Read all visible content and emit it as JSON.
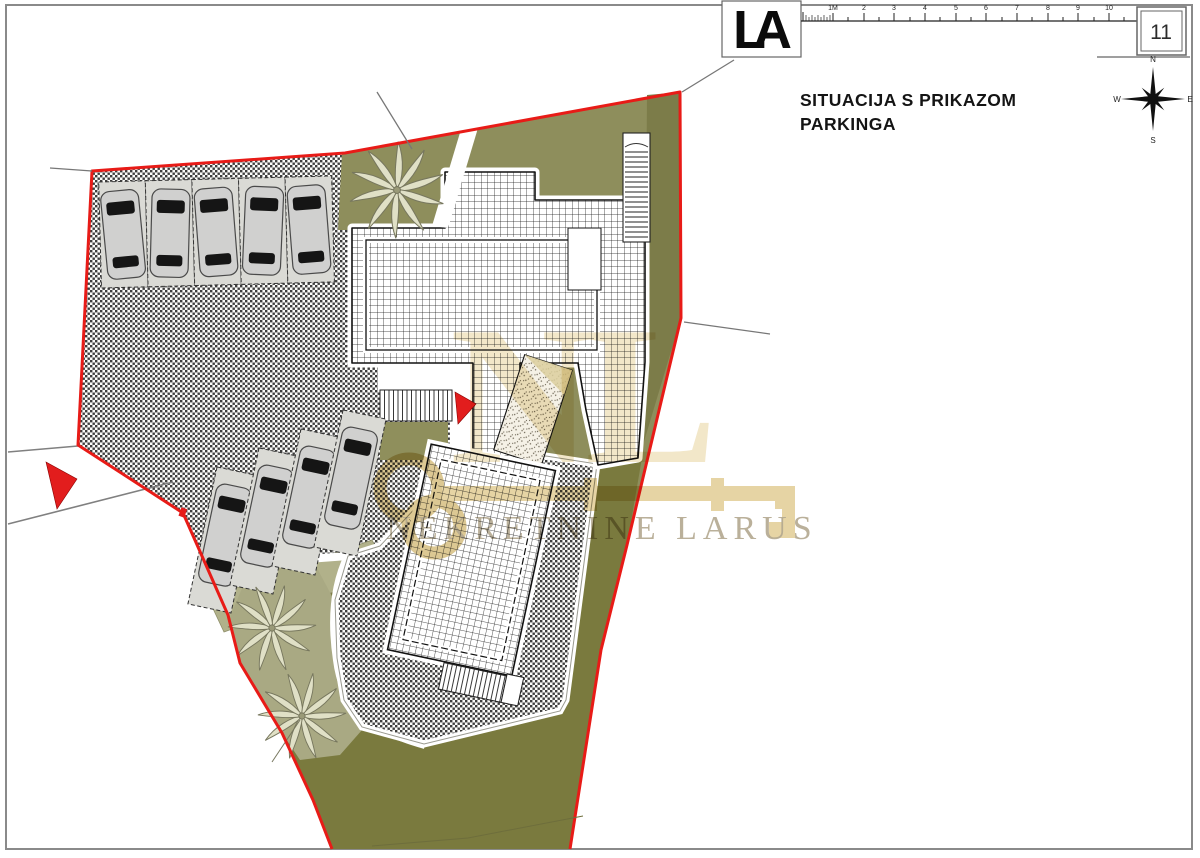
{
  "header": {
    "logo": "LA",
    "sheet_number": "11",
    "title_line1": "SITUACIJA S PRIKAZOM",
    "title_line2": "PARKINGA"
  },
  "scale_ruler": {
    "labels": [
      "1M",
      "2",
      "3",
      "4",
      "5",
      "6",
      "7",
      "8",
      "9",
      "10"
    ]
  },
  "compass": {
    "north": "N",
    "east": "E",
    "south": "S",
    "west": "W"
  },
  "watermark": {
    "monogram": "NL",
    "text": "NEKRETNINE LARUS"
  },
  "site_plan": {
    "parking_top_row_spaces": 5,
    "parking_lower_row_spaces": 4,
    "palm_trees": 3,
    "entrance_arrows": 2
  },
  "colors": {
    "boundary_red": "#E81B17",
    "green_base": "#8E8E5C",
    "green_dark": "#7A7A3E",
    "green_strip_right": "#7C7C49",
    "green_light_pad": "#B1B18A",
    "green_light_strip": "#A9A983",
    "watermark_beige": "#E6D4A4",
    "watermark_letters": "#EFE2BE",
    "watermark_text": "#B3A88F",
    "car_body": "#D0D0CF"
  }
}
